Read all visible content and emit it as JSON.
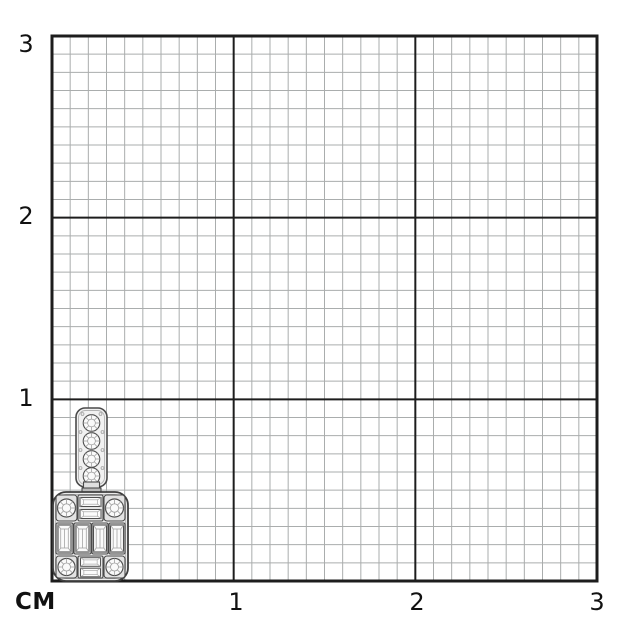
{
  "figure": {
    "description": "White-gold diamond pendant photographed on centimeter measurement grid paper"
  },
  "axes": {
    "unit_label": "СМ",
    "x_ticks": [
      "1",
      "2",
      "3"
    ],
    "y_ticks": [
      "3",
      "2",
      "1"
    ]
  },
  "scale": {
    "unit": "cm",
    "x_range": [
      0,
      3
    ],
    "y_range": [
      0,
      3
    ],
    "minor_per_unit": 10
  },
  "grid": {
    "bg": "#ffffff",
    "minor_color": "#aaadad",
    "major_color": "#1d1d1d",
    "border_color": "#1d1d1d"
  },
  "subject": {
    "type": "diamond-pendant",
    "position": "bottom-left",
    "approx_width_cm": 0.4,
    "approx_height_cm": 0.95,
    "features": "vertical bail set with 4 round diamonds; rounded-square head with 4 corner round diamonds, 2 pairs of stacked horizontal baguettes, and 4 vertical baguette diamonds"
  }
}
